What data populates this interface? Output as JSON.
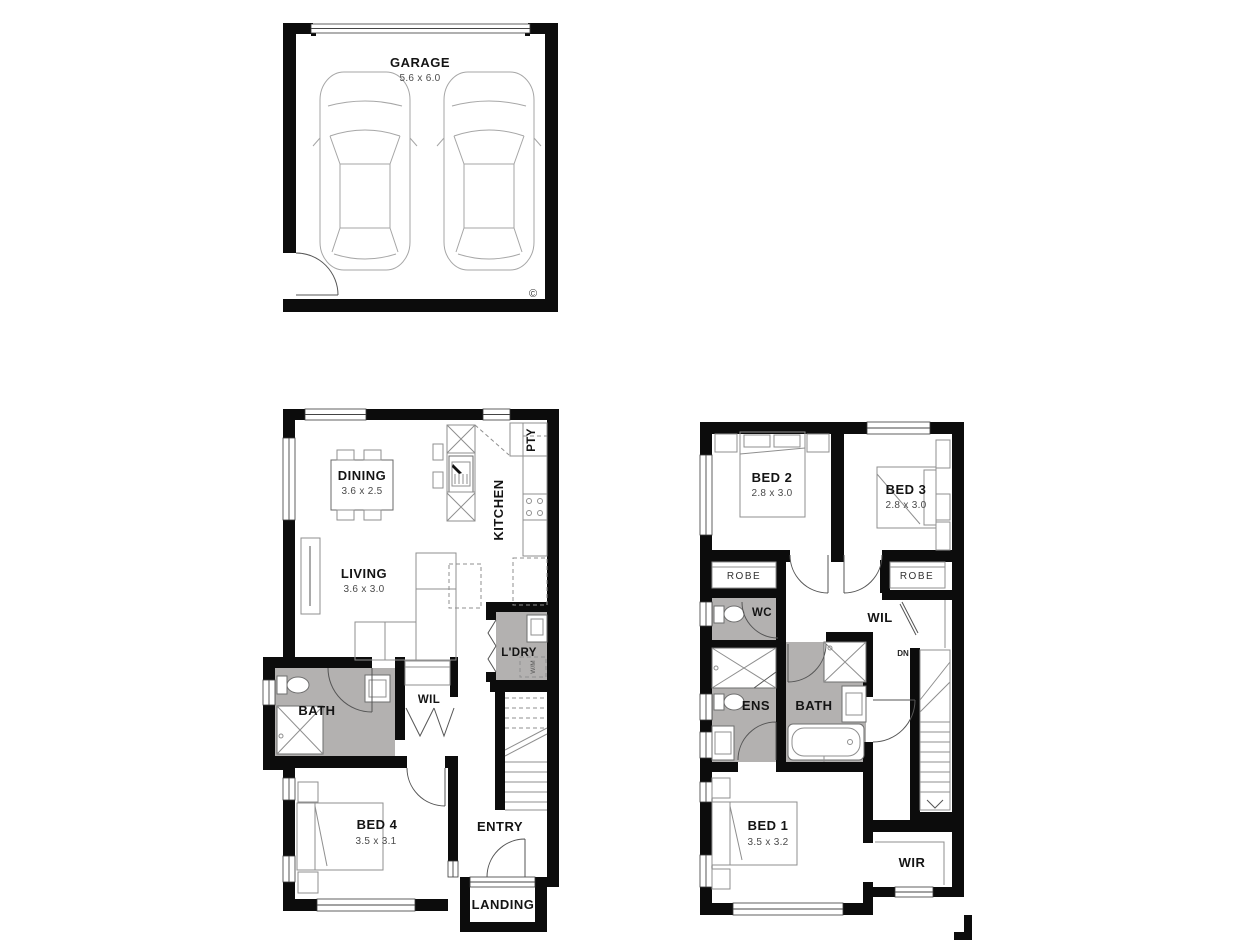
{
  "garage": {
    "label": "GARAGE",
    "dims": "5.6 x 6.0",
    "copyright": "©"
  },
  "ground": {
    "dining": {
      "label": "DINING",
      "dims": "3.6 x 2.5"
    },
    "living": {
      "label": "LIVING",
      "dims": "3.6 x 3.0"
    },
    "kitchen": {
      "label": "KITCHEN"
    },
    "pantry": {
      "label": "PTY"
    },
    "laundry": {
      "label": "L'DRY",
      "appliance": "W/M"
    },
    "bath": {
      "label": "BATH"
    },
    "linen": {
      "label": "WIL"
    },
    "bed4": {
      "label": "BED 4",
      "dims": "3.5 x 3.1"
    },
    "entry": {
      "label": "ENTRY"
    },
    "landing": {
      "label": "LANDING"
    }
  },
  "upper": {
    "bed2": {
      "label": "BED 2",
      "dims": "2.8 x 3.0"
    },
    "bed3": {
      "label": "BED 3",
      "dims": "2.8 x 3.0"
    },
    "robe2": {
      "label": "ROBE"
    },
    "robe3": {
      "label": "ROBE"
    },
    "wc": {
      "label": "WC"
    },
    "linen": {
      "label": "WIL"
    },
    "stairs": {
      "label": "DN"
    },
    "ens": {
      "label": "ENS"
    },
    "bath": {
      "label": "BATH"
    },
    "bed1": {
      "label": "BED 1",
      "dims": "3.5 x 3.2"
    },
    "wir": {
      "label": "WIR"
    }
  },
  "colors": {
    "wall": "#0c0c0c",
    "wet_area": "#b3b1b0",
    "fixture": "#8f8f8f"
  }
}
